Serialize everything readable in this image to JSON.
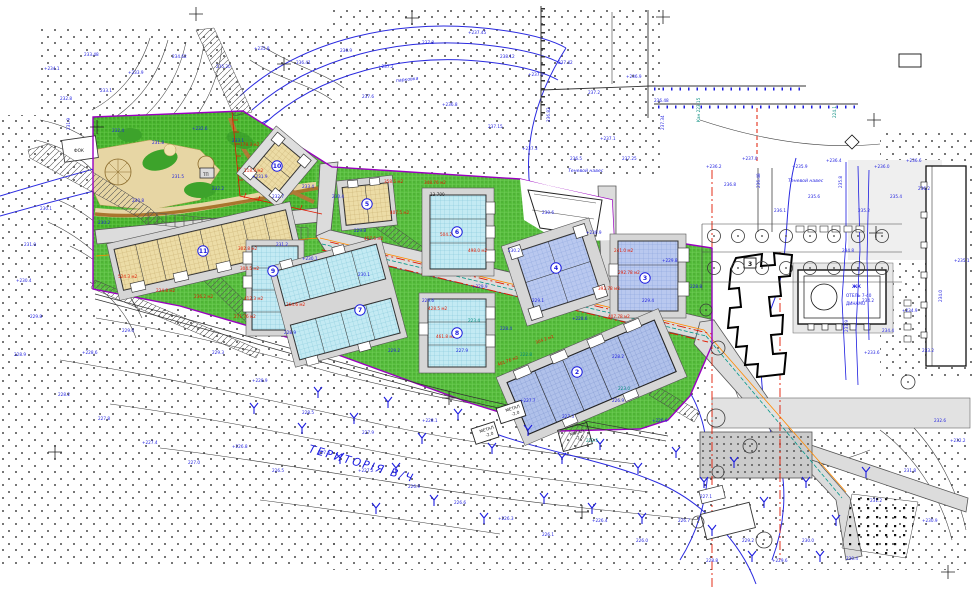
{
  "canvas": {
    "w": 972,
    "h": 592
  },
  "palette": {
    "annotation_blue": "#1c1cdf",
    "area_red": "#e11900",
    "utility_teal": "#00897b",
    "lawn_green": "#56bd3c",
    "park_green": "#49b52e",
    "building_beige": "#ecdca6",
    "building_cyan": "#c3eaf3",
    "building_periwinkle": "#b9c8ef",
    "road_gray": "#dcdcdc",
    "boundary_purple": "#9a00c0",
    "axis_red": "#e11900",
    "utility_orange": "#ff8a00",
    "contour_gray": "#3c3c3c"
  },
  "labels": {
    "territory": "ТЕРИТОРІЯ В/Ч",
    "canopy_top": "Теневой навес",
    "canopy_right": "Теневой навес",
    "hotel_line1": "ЖК",
    "hotel_line2": "ОТЕЛЬ 7-40",
    "hotel_line3": "ДИНАМО",
    "park_building": "ФОК",
    "substation": "ТП",
    "dim_13700": "13 700",
    "existing_floors": "3",
    "parking": "парковка"
  },
  "annotations": {
    "elevations_blue": [
      {
        "t": "+234.1",
        "x": 44,
        "y": 70
      },
      {
        "t": "233.48",
        "x": 84,
        "y": 56
      },
      {
        "t": "+233.9",
        "x": 128,
        "y": 74
      },
      {
        "t": "234.62",
        "x": 172,
        "y": 58
      },
      {
        "t": "235.20",
        "x": 216,
        "y": 68
      },
      {
        "t": "+235.8",
        "x": 254,
        "y": 50
      },
      {
        "t": "236.41",
        "x": 296,
        "y": 64
      },
      {
        "t": "232.8",
        "x": 60,
        "y": 100
      },
      {
        "t": "233.1",
        "x": 100,
        "y": 92
      },
      {
        "t": "231.9",
        "x": 70,
        "y": 130,
        "r": -90
      },
      {
        "t": "236.9",
        "x": 340,
        "y": 52
      },
      {
        "t": "+237.2",
        "x": 378,
        "y": 68
      },
      {
        "t": "237.8",
        "x": 422,
        "y": 44
      },
      {
        "t": "+237.45",
        "x": 468,
        "y": 34
      },
      {
        "t": "238.12",
        "x": 500,
        "y": 58
      },
      {
        "t": "+237.9",
        "x": 528,
        "y": 76
      },
      {
        "t": "237.6",
        "x": 362,
        "y": 98
      },
      {
        "t": "+236.8",
        "x": 442,
        "y": 106
      },
      {
        "t": "237.15",
        "x": 488,
        "y": 128
      },
      {
        "t": "+237.3",
        "x": 522,
        "y": 150
      },
      {
        "t": "237.42",
        "x": 558,
        "y": 64
      },
      {
        "t": "237.2",
        "x": 588,
        "y": 94
      },
      {
        "t": "+236.9",
        "x": 626,
        "y": 78
      },
      {
        "t": "236.48",
        "x": 654,
        "y": 102
      },
      {
        "t": "237.34",
        "x": 664,
        "y": 130,
        "r": -90
      },
      {
        "t": "236.82",
        "x": 550,
        "y": 122,
        "r": -90
      },
      {
        "t": "+237.1",
        "x": 600,
        "y": 140
      },
      {
        "t": "236.5",
        "x": 570,
        "y": 160
      },
      {
        "t": "237.25",
        "x": 622,
        "y": 160
      },
      {
        "t": "232.4",
        "x": 112,
        "y": 132
      },
      {
        "t": "231.8",
        "x": 152,
        "y": 144
      },
      {
        "t": "+232.6",
        "x": 192,
        "y": 130
      },
      {
        "t": "233.1",
        "x": 232,
        "y": 142
      },
      {
        "t": "231.5",
        "x": 172,
        "y": 178
      },
      {
        "t": "232.2",
        "x": 212,
        "y": 190
      },
      {
        "t": "+231.9",
        "x": 252,
        "y": 178
      },
      {
        "t": "230.8",
        "x": 132,
        "y": 202
      },
      {
        "t": "230.2",
        "x": 98,
        "y": 224
      },
      {
        "t": "232.7",
        "x": 272,
        "y": 198
      },
      {
        "t": "233.4",
        "x": 302,
        "y": 188
      },
      {
        "t": "230.4",
        "x": 332,
        "y": 198
      },
      {
        "t": "229.8",
        "x": 354,
        "y": 232
      },
      {
        "t": "+230.1",
        "x": 302,
        "y": 260
      },
      {
        "t": "228.9",
        "x": 284,
        "y": 334
      },
      {
        "t": "229.6",
        "x": 422,
        "y": 302
      },
      {
        "t": "+229.9",
        "x": 472,
        "y": 288
      },
      {
        "t": "230.2",
        "x": 508,
        "y": 252
      },
      {
        "t": "229.1",
        "x": 532,
        "y": 302
      },
      {
        "t": "+228.6",
        "x": 572,
        "y": 320
      },
      {
        "t": "228.2",
        "x": 612,
        "y": 358
      },
      {
        "t": "229.4",
        "x": 642,
        "y": 302
      },
      {
        "t": "+229.8",
        "x": 662,
        "y": 262
      },
      {
        "t": "228.8",
        "x": 690,
        "y": 288
      },
      {
        "t": "230.6",
        "x": 542,
        "y": 214
      },
      {
        "t": "+230.9",
        "x": 586,
        "y": 234
      },
      {
        "t": "228.4",
        "x": 500,
        "y": 330
      },
      {
        "t": "227.9",
        "x": 456,
        "y": 352
      },
      {
        "t": "229.2",
        "x": 388,
        "y": 352
      },
      {
        "t": "230.1",
        "x": 358,
        "y": 276
      },
      {
        "t": "231.2",
        "x": 276,
        "y": 246
      },
      {
        "t": "+236.2",
        "x": 706,
        "y": 168
      },
      {
        "t": "236.8",
        "x": 724,
        "y": 186
      },
      {
        "t": "+237.0",
        "x": 742,
        "y": 160
      },
      {
        "t": "236.48",
        "x": 760,
        "y": 188,
        "r": -90
      },
      {
        "t": "236.1",
        "x": 774,
        "y": 212
      },
      {
        "t": "+235.9",
        "x": 792,
        "y": 168
      },
      {
        "t": "235.6",
        "x": 808,
        "y": 198
      },
      {
        "t": "+236.4",
        "x": 826,
        "y": 162
      },
      {
        "t": "235.8",
        "x": 842,
        "y": 188,
        "r": -90
      },
      {
        "t": "235.2",
        "x": 858,
        "y": 212
      },
      {
        "t": "+236.0",
        "x": 874,
        "y": 168
      },
      {
        "t": "235.4",
        "x": 890,
        "y": 198
      },
      {
        "t": "+236.6",
        "x": 906,
        "y": 162
      },
      {
        "t": "236.2",
        "x": 918,
        "y": 190
      },
      {
        "t": "234.8",
        "x": 842,
        "y": 252
      },
      {
        "t": "234.2",
        "x": 862,
        "y": 302
      },
      {
        "t": "233.9",
        "x": 848,
        "y": 332,
        "r": -90
      },
      {
        "t": "+233.6",
        "x": 864,
        "y": 354
      },
      {
        "t": "234.4",
        "x": 882,
        "y": 332
      },
      {
        "t": "+234.9",
        "x": 902,
        "y": 312
      },
      {
        "t": "233.2",
        "x": 922,
        "y": 352
      },
      {
        "t": "234.0",
        "x": 942,
        "y": 302,
        "r": -90
      },
      {
        "t": "+235.1",
        "x": 954,
        "y": 262
      },
      {
        "t": "232.6",
        "x": 934,
        "y": 422
      },
      {
        "t": "+232.2",
        "x": 950,
        "y": 442
      },
      {
        "t": "231.8",
        "x": 904,
        "y": 472
      },
      {
        "t": "231.2",
        "x": 870,
        "y": 502
      },
      {
        "t": "+230.9",
        "x": 922,
        "y": 522
      },
      {
        "t": "230.4",
        "x": 846,
        "y": 560
      },
      {
        "t": "230.0",
        "x": 802,
        "y": 542
      },
      {
        "t": "+229.6",
        "x": 772,
        "y": 562
      },
      {
        "t": "229.2",
        "x": 742,
        "y": 542
      },
      {
        "t": "228.8",
        "x": 706,
        "y": 562
      },
      {
        "t": "229.0",
        "x": 122,
        "y": 332
      },
      {
        "t": "+228.6",
        "x": 82,
        "y": 354
      },
      {
        "t": "228.2",
        "x": 58,
        "y": 396
      },
      {
        "t": "227.8",
        "x": 98,
        "y": 420
      },
      {
        "t": "+227.4",
        "x": 142,
        "y": 444
      },
      {
        "t": "227.0",
        "x": 188,
        "y": 464
      },
      {
        "t": "+226.8",
        "x": 232,
        "y": 448
      },
      {
        "t": "226.5",
        "x": 272,
        "y": 472
      },
      {
        "t": "227.6",
        "x": 318,
        "y": 454
      },
      {
        "t": "+227.2",
        "x": 358,
        "y": 472
      },
      {
        "t": "226.9",
        "x": 408,
        "y": 488
      },
      {
        "t": "226.6",
        "x": 454,
        "y": 504
      },
      {
        "t": "+226.3",
        "x": 498,
        "y": 520
      },
      {
        "t": "226.1",
        "x": 542,
        "y": 536
      },
      {
        "t": "+226.4",
        "x": 592,
        "y": 522
      },
      {
        "t": "226.0",
        "x": 636,
        "y": 542
      },
      {
        "t": "226.7",
        "x": 678,
        "y": 522
      },
      {
        "t": "227.1",
        "x": 700,
        "y": 498
      },
      {
        "t": "227.9",
        "x": 362,
        "y": 434
      },
      {
        "t": "+228.1",
        "x": 422,
        "y": 422
      },
      {
        "t": "228.5",
        "x": 302,
        "y": 414
      },
      {
        "t": "+228.9",
        "x": 252,
        "y": 382
      },
      {
        "t": "229.3",
        "x": 212,
        "y": 354
      },
      {
        "t": "+227.7",
        "x": 520,
        "y": 402
      },
      {
        "t": "227.3",
        "x": 562,
        "y": 418
      },
      {
        "t": "226.9",
        "x": 612,
        "y": 402
      },
      {
        "t": "+226.6",
        "x": 652,
        "y": 422
      },
      {
        "t": "229.8",
        "x": 30,
        "y": 318
      },
      {
        "t": "+230.4",
        "x": 16,
        "y": 282
      },
      {
        "t": "231.0",
        "x": 24,
        "y": 246
      },
      {
        "t": "230.1",
        "x": 40,
        "y": 210
      },
      {
        "t": "228.9",
        "x": 14,
        "y": 356
      }
    ],
    "areas_red": [
      {
        "t": "178.3 м2",
        "x": 240,
        "y": 146
      },
      {
        "t": "118.3 м2",
        "x": 244,
        "y": 172
      },
      {
        "t": "348.76 м2",
        "x": 424,
        "y": 184
      },
      {
        "t": "358.5 м2",
        "x": 384,
        "y": 183
      },
      {
        "t": "407.5 м2",
        "x": 390,
        "y": 214
      },
      {
        "t": "457.5 м2",
        "x": 364,
        "y": 240
      },
      {
        "t": "504.2 м2",
        "x": 440,
        "y": 236
      },
      {
        "t": "498.0 м2",
        "x": 468,
        "y": 252
      },
      {
        "t": "241.0 м2",
        "x": 614,
        "y": 252
      },
      {
        "t": "292.78 м2",
        "x": 618,
        "y": 274
      },
      {
        "t": "392.78 м2",
        "x": 598,
        "y": 290
      },
      {
        "t": "407.78 м2",
        "x": 608,
        "y": 318
      },
      {
        "t": "302.8 м2",
        "x": 238,
        "y": 250
      },
      {
        "t": "304.5 м2",
        "x": 240,
        "y": 270
      },
      {
        "t": "524.3 м2",
        "x": 118,
        "y": 278
      },
      {
        "t": "234.8 м2",
        "x": 156,
        "y": 292
      },
      {
        "t": "236.2 м2",
        "x": 194,
        "y": 298
      },
      {
        "t": "412.3 м2",
        "x": 244,
        "y": 300
      },
      {
        "t": "264.6 м2",
        "x": 286,
        "y": 306
      },
      {
        "t": "271.76 м2",
        "x": 234,
        "y": 318
      },
      {
        "t": "428.5 м2",
        "x": 428,
        "y": 310
      },
      {
        "t": "461.8 м2",
        "x": 436,
        "y": 338
      },
      {
        "t": "304.2 м2",
        "x": 536,
        "y": 344,
        "r": -20
      },
      {
        "t": "481.76 м2",
        "x": 498,
        "y": 366,
        "r": -20
      }
    ],
    "utilities_teal": [
      {
        "t": "223.4",
        "x": 468,
        "y": 322
      },
      {
        "t": "Кан 223.15",
        "x": 700,
        "y": 122,
        "r": -90
      },
      {
        "t": "222.8",
        "x": 520,
        "y": 356
      },
      {
        "t": "223.0",
        "x": 618,
        "y": 390
      },
      {
        "t": "224.1",
        "x": 836,
        "y": 118,
        "r": -90
      },
      {
        "t": "222.5",
        "x": 586,
        "y": 442
      }
    ],
    "misc_black": [
      {
        "t": "МЕТАЛ",
        "x": 506,
        "y": 412,
        "r": -18,
        "s": 3.2
      },
      {
        "t": "-2.0",
        "x": 512,
        "y": 416,
        "r": -18,
        "s": 3.2
      },
      {
        "t": "МЕТАЛ",
        "x": 480,
        "y": 433,
        "r": -18,
        "s": 3.2
      },
      {
        "t": "-2.0",
        "x": 486,
        "y": 437,
        "r": -18,
        "s": 3.2
      },
      {
        "t": "МЕТАЛ",
        "x": 570,
        "y": 436,
        "r": -15,
        "s": 3.2
      },
      {
        "t": "-2.0",
        "x": 576,
        "y": 440,
        "r": -15,
        "s": 3.2
      }
    ]
  },
  "building_markers": [
    {
      "n": "2",
      "x": 577,
      "y": 372
    },
    {
      "n": "3",
      "x": 645,
      "y": 278
    },
    {
      "n": "4",
      "x": 556,
      "y": 268
    },
    {
      "n": "5",
      "x": 367,
      "y": 204
    },
    {
      "n": "6",
      "x": 457,
      "y": 232
    },
    {
      "n": "7",
      "x": 360,
      "y": 310
    },
    {
      "n": "8",
      "x": 457,
      "y": 333
    },
    {
      "n": "9",
      "x": 273,
      "y": 271
    },
    {
      "n": "10",
      "x": 277,
      "y": 166
    },
    {
      "n": "11",
      "x": 203,
      "y": 251
    }
  ],
  "symbols": {
    "trees_deciduous": [
      [
        714,
        236,
        6.5
      ],
      [
        738,
        236,
        6.5
      ],
      [
        762,
        236,
        6.5
      ],
      [
        786,
        236,
        6.5
      ],
      [
        810,
        236,
        6.5
      ],
      [
        834,
        236,
        6.5
      ],
      [
        858,
        236,
        6.5
      ],
      [
        882,
        236,
        6.5
      ],
      [
        714,
        268,
        6.5
      ],
      [
        738,
        268,
        6.5
      ],
      [
        762,
        268,
        6.5
      ],
      [
        786,
        268,
        6.5
      ],
      [
        810,
        268,
        6.5
      ],
      [
        834,
        268,
        6.5
      ],
      [
        858,
        268,
        6.5
      ],
      [
        882,
        268,
        6.5
      ],
      [
        716,
        418,
        9
      ],
      [
        750,
        446,
        7
      ],
      [
        718,
        472,
        6
      ],
      [
        764,
        540,
        8
      ],
      [
        698,
        522,
        6
      ],
      [
        908,
        382,
        7
      ],
      [
        718,
        348,
        7
      ],
      [
        706,
        310,
        6
      ]
    ],
    "trees_young": [
      [
        318,
        392
      ],
      [
        354,
        418
      ],
      [
        388,
        402
      ],
      [
        422,
        438
      ],
      [
        458,
        414
      ],
      [
        492,
        448
      ],
      [
        528,
        430
      ],
      [
        562,
        458
      ],
      [
        600,
        444
      ],
      [
        638,
        468
      ],
      [
        676,
        452
      ],
      [
        340,
        458
      ],
      [
        396,
        468
      ],
      [
        302,
        428
      ],
      [
        254,
        408
      ],
      [
        704,
        482
      ],
      [
        734,
        462
      ],
      [
        764,
        502
      ],
      [
        806,
        482
      ],
      [
        836,
        520
      ],
      [
        866,
        472
      ],
      [
        642,
        518
      ],
      [
        592,
        508
      ],
      [
        544,
        498
      ],
      [
        484,
        518
      ],
      [
        434,
        500
      ],
      [
        376,
        508
      ],
      [
        712,
        530
      ],
      [
        752,
        556
      ],
      [
        820,
        556
      ]
    ],
    "survey_crosses": [
      [
        196,
        14
      ],
      [
        412,
        18
      ],
      [
        663,
        17
      ],
      [
        97,
        127
      ],
      [
        874,
        120
      ],
      [
        876,
        233
      ],
      [
        582,
        512
      ],
      [
        449,
        398
      ],
      [
        55,
        452
      ],
      [
        948,
        572
      ],
      [
        284,
        64
      ]
    ]
  }
}
